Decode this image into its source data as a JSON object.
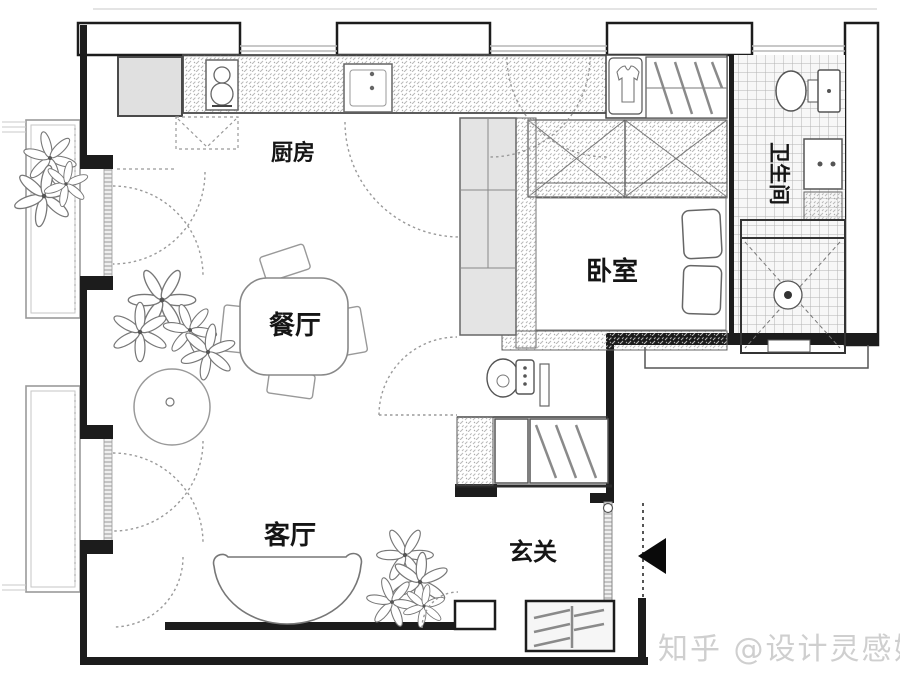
{
  "floorplan": {
    "title": "apartment-floor-plan",
    "rooms": [
      {
        "id": "kitchen",
        "label": "厨房"
      },
      {
        "id": "dining",
        "label": "餐厅"
      },
      {
        "id": "bedroom",
        "label": "卧室"
      },
      {
        "id": "bathroom",
        "label": "卫生间"
      },
      {
        "id": "living",
        "label": "客厅"
      },
      {
        "id": "entry",
        "label": "玄关"
      }
    ],
    "watermark": "知乎 @设计灵感姐",
    "icons": [
      "refrigerator-icon",
      "stove-icon",
      "kitchen-sink-icon",
      "shirt-wardrobe-icon",
      "shelf-icon",
      "closet-x-icon",
      "toilet-icon",
      "vanity-sink-icon",
      "shower-drain-icon",
      "bed-icon",
      "pillow-icon",
      "dining-table-icon",
      "chair-icon",
      "sofa-icon",
      "plant-icon",
      "round-rug-icon",
      "washbasin-icon",
      "hall-wardrobe-icon",
      "shoe-cabinet-icon",
      "sliding-door-icon",
      "entry-arrow-icon",
      "door-swing-arc",
      "window-band",
      "balcony-outline"
    ],
    "colors": {
      "wall": "#1c1c1c",
      "outline": "#555555",
      "hatch": "#b8b8b8",
      "tile_grid": "#b3b3b3",
      "light_fill": "#e3e3e3",
      "window_line": "#b5b5b5",
      "arrow": "#0a0a0a",
      "watermark": "#cfcfcf"
    }
  }
}
